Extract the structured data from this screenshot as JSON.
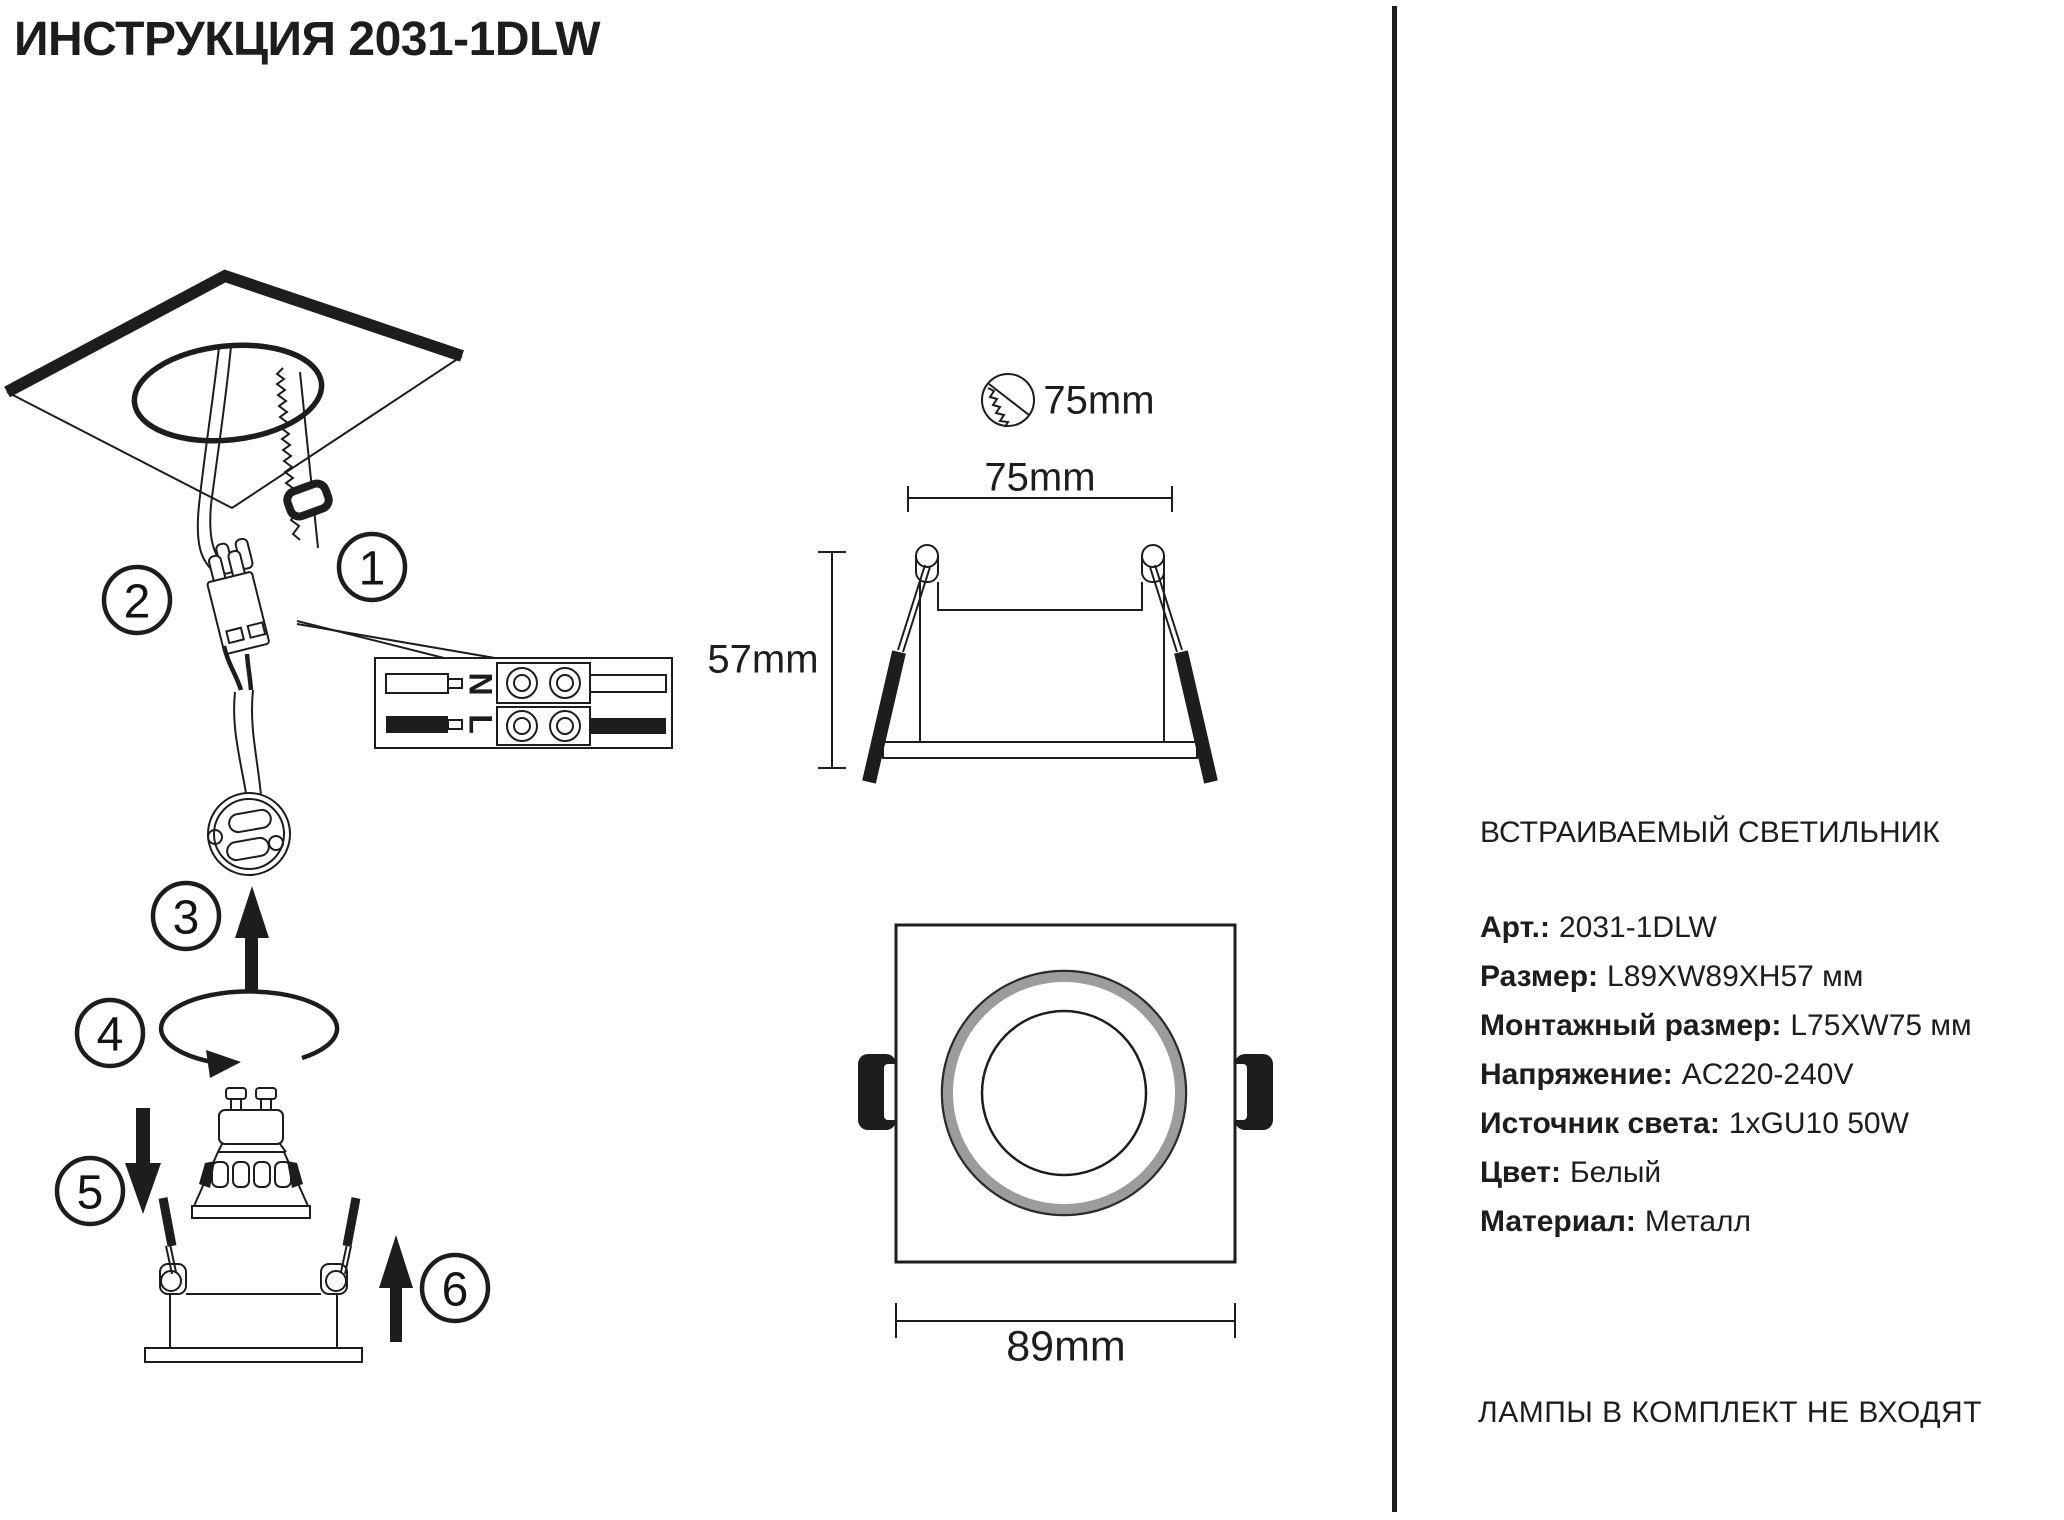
{
  "title": "ИНСТРУКЦИЯ 2031-1DLW",
  "steps": [
    "1",
    "2",
    "3",
    "4",
    "5",
    "6"
  ],
  "dimensions": {
    "cutout_diameter": "75mm",
    "mounting_width": "75mm",
    "height": "57mm",
    "overall_width": "89mm"
  },
  "wiring_labels": {
    "neutral": "N",
    "live": "L"
  },
  "product": {
    "type": "ВСТРАИВАЕМЫЙ СВЕТИЛЬНИК",
    "specs": [
      {
        "label": "Арт.:",
        "value": "2031-1DLW"
      },
      {
        "label": "Размер:",
        "value": "L89XW89XH57 мм"
      },
      {
        "label": "Монтажный размер:",
        "value": "L75XW75 мм"
      },
      {
        "label": "Напряжение:",
        "value": "AC220-240V"
      },
      {
        "label": "Источник света:",
        "value": "1xGU10 50W"
      },
      {
        "label": "Цвет:",
        "value": "Белый"
      },
      {
        "label": "Материал:",
        "value": "Металл"
      }
    ],
    "note": "ЛАМПЫ В КОМПЛЕКТ НЕ ВХОДЯТ"
  },
  "colors": {
    "ink": "#1d1d1b",
    "ring_gray": "#9c9c9c",
    "background": "#ffffff"
  }
}
